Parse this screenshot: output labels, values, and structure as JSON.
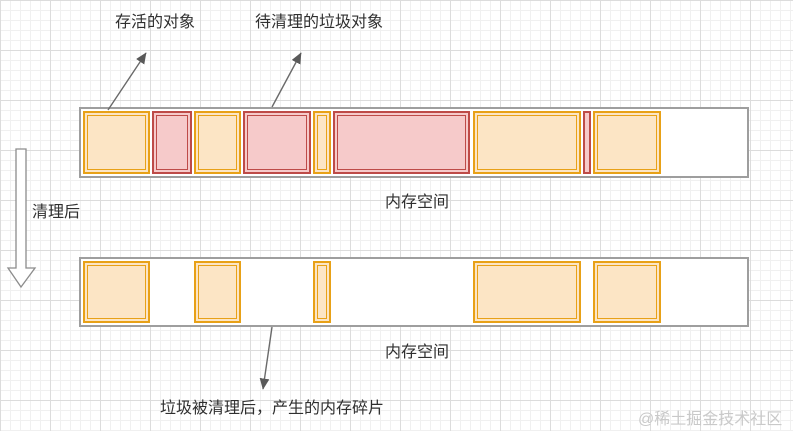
{
  "labels": {
    "live_object": "存活的对象",
    "garbage_object": "待清理的垃圾对象",
    "after_cleanup": "清理后",
    "memory_space_top": "内存空间",
    "memory_space_bottom": "内存空间",
    "fragment_caption": "垃圾被清理后，产生的内存碎片",
    "watermark": "@稀土掘金技术社区"
  },
  "colors": {
    "live_fill": "#FCE5C5",
    "live_border": "#E8A117",
    "garbage_fill": "#F6CACA",
    "garbage_border": "#BE4B48",
    "bar_border": "#9E9E9E",
    "arrow": "#6A6A6A",
    "watermark": "#C9C9C9",
    "grid_minor": "#F0F0F0",
    "grid_major": "#DCDCDC"
  },
  "bars": [
    {
      "name": "memory-bar-before",
      "x": 79,
      "y": 107,
      "w": 670,
      "h": 71,
      "blocks": [
        {
          "type": "live",
          "x": 2,
          "w": 67
        },
        {
          "type": "garbage",
          "x": 71,
          "w": 40
        },
        {
          "type": "live",
          "x": 113,
          "w": 47
        },
        {
          "type": "garbage",
          "x": 162,
          "w": 68
        },
        {
          "type": "live",
          "x": 232,
          "w": 18
        },
        {
          "type": "garbage",
          "x": 252,
          "w": 137
        },
        {
          "type": "live",
          "x": 392,
          "w": 108
        },
        {
          "type": "garbage",
          "x": 502,
          "w": 8
        },
        {
          "type": "live",
          "x": 512,
          "w": 68
        }
      ]
    },
    {
      "name": "memory-bar-after",
      "x": 79,
      "y": 257,
      "w": 670,
      "h": 70,
      "blocks": [
        {
          "type": "live",
          "x": 2,
          "w": 67
        },
        {
          "type": "live",
          "x": 113,
          "w": 47
        },
        {
          "type": "live",
          "x": 232,
          "w": 18
        },
        {
          "type": "live",
          "x": 392,
          "w": 108
        },
        {
          "type": "live",
          "x": 512,
          "w": 68
        }
      ]
    }
  ]
}
